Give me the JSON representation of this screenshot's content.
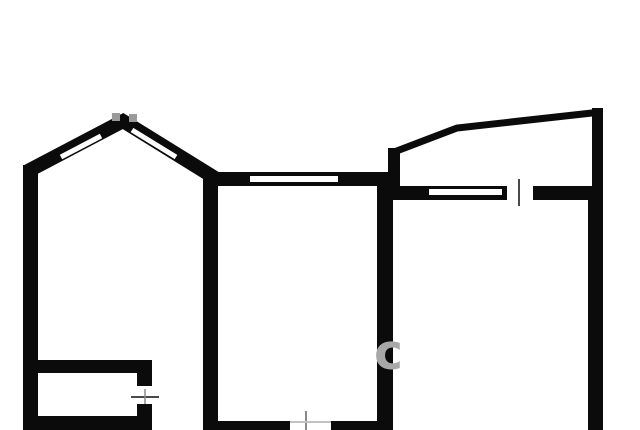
{
  "meta": {
    "title": "apartment-floor-plan",
    "width": 640,
    "height": 430
  },
  "colors": {
    "background": "#ffffff",
    "wall": "#0b0b0b",
    "window": "#ffffff",
    "gap": "#ffffff",
    "tick": "#4a4a4a",
    "tick_soft": "#8a8a8a",
    "tick_faint": "#c2c2c2",
    "apex_notch": "#9a9a9a",
    "watermark": "#a8a8a8"
  },
  "plan": {
    "walls_rects": [
      {
        "name": "left-outer-wall",
        "x": 23,
        "y": 165,
        "w": 15,
        "h": 265
      },
      {
        "name": "left-room-divider-wall",
        "x": 203,
        "y": 172,
        "w": 15,
        "h": 258
      },
      {
        "name": "center-room-divider-wall",
        "x": 377,
        "y": 177,
        "w": 16,
        "h": 253
      },
      {
        "name": "balcony-right-wall",
        "x": 592,
        "y": 108,
        "w": 11,
        "h": 95
      },
      {
        "name": "right-outer-wall",
        "x": 588,
        "y": 186,
        "w": 15,
        "h": 244
      },
      {
        "name": "center-room-top-wall",
        "x": 203,
        "y": 172,
        "w": 190,
        "h": 14
      },
      {
        "name": "right-room-top-wall",
        "x": 393,
        "y": 186,
        "w": 197,
        "h": 14
      },
      {
        "name": "balcony-left-stub-wall",
        "x": 388,
        "y": 148,
        "w": 12,
        "h": 40
      },
      {
        "name": "bottom-outer-wall-left",
        "x": 23,
        "y": 416,
        "w": 129,
        "h": 14
      },
      {
        "name": "storage-room-top-wall",
        "x": 38,
        "y": 360,
        "w": 114,
        "h": 13
      },
      {
        "name": "storage-room-right-wall-upper",
        "x": 137,
        "y": 360,
        "w": 15,
        "h": 26
      },
      {
        "name": "storage-room-right-wall-lower",
        "x": 137,
        "y": 404,
        "w": 15,
        "h": 13
      },
      {
        "name": "center-room-bottom-wall-left",
        "x": 203,
        "y": 421,
        "w": 87,
        "h": 9
      },
      {
        "name": "center-room-bottom-wall-right",
        "x": 331,
        "y": 421,
        "w": 62,
        "h": 9
      }
    ],
    "walls_polylines": [
      {
        "name": "bay-peak-wall",
        "points": "28,171 123,121 215,178",
        "width": 14,
        "color": "wall"
      },
      {
        "name": "balcony-outline",
        "points": "394,186 394,152 457,128 601,112",
        "width": 7,
        "color": "wall"
      }
    ],
    "window_slots": [
      {
        "name": "bay-window-left-slot",
        "x1": 61,
        "y1": 157,
        "x2": 101,
        "y2": 136,
        "width": 5
      },
      {
        "name": "bay-window-right-slot",
        "x1": 132,
        "y1": 130,
        "x2": 176,
        "y2": 157,
        "width": 5
      },
      {
        "name": "center-room-top-window",
        "x1": 250,
        "y1": 179,
        "x2": 338,
        "y2": 179,
        "width": 6
      },
      {
        "name": "right-room-top-window",
        "x1": 429,
        "y1": 192,
        "x2": 502,
        "y2": 192,
        "width": 6
      }
    ],
    "door_gaps": [
      {
        "name": "right-room-top-door-gap",
        "x": 507,
        "y": 186,
        "w": 26,
        "h": 14
      }
    ],
    "symbols": [
      {
        "name": "right-room-door-tick",
        "x1": 519,
        "y1": 179,
        "x2": 519,
        "y2": 206,
        "width": 2,
        "color": "tick"
      },
      {
        "name": "storage-door-tick-horizontal",
        "x1": 131,
        "y1": 397,
        "x2": 159,
        "y2": 397,
        "width": 2,
        "color": "tick"
      },
      {
        "name": "storage-door-tick-vertical",
        "x1": 145,
        "y1": 389,
        "x2": 145,
        "y2": 404,
        "width": 1.5,
        "color": "tick_soft"
      },
      {
        "name": "center-room-bottom-tick-vertical",
        "x1": 306,
        "y1": 411,
        "x2": 306,
        "y2": 430,
        "width": 2,
        "color": "tick_soft"
      },
      {
        "name": "center-room-bottom-tick-horizontal",
        "x1": 290,
        "y1": 422,
        "x2": 331,
        "y2": 422,
        "width": 2,
        "color": "tick_faint"
      }
    ],
    "apex_notches": [
      {
        "name": "bay-apex-notch-left",
        "x": 112,
        "y": 113,
        "w": 8,
        "h": 8
      },
      {
        "name": "bay-apex-notch-right",
        "x": 129,
        "y": 114,
        "w": 8,
        "h": 8
      }
    ],
    "watermark": {
      "text": "c",
      "x": 374,
      "y": 369,
      "font_size": 49
    }
  }
}
